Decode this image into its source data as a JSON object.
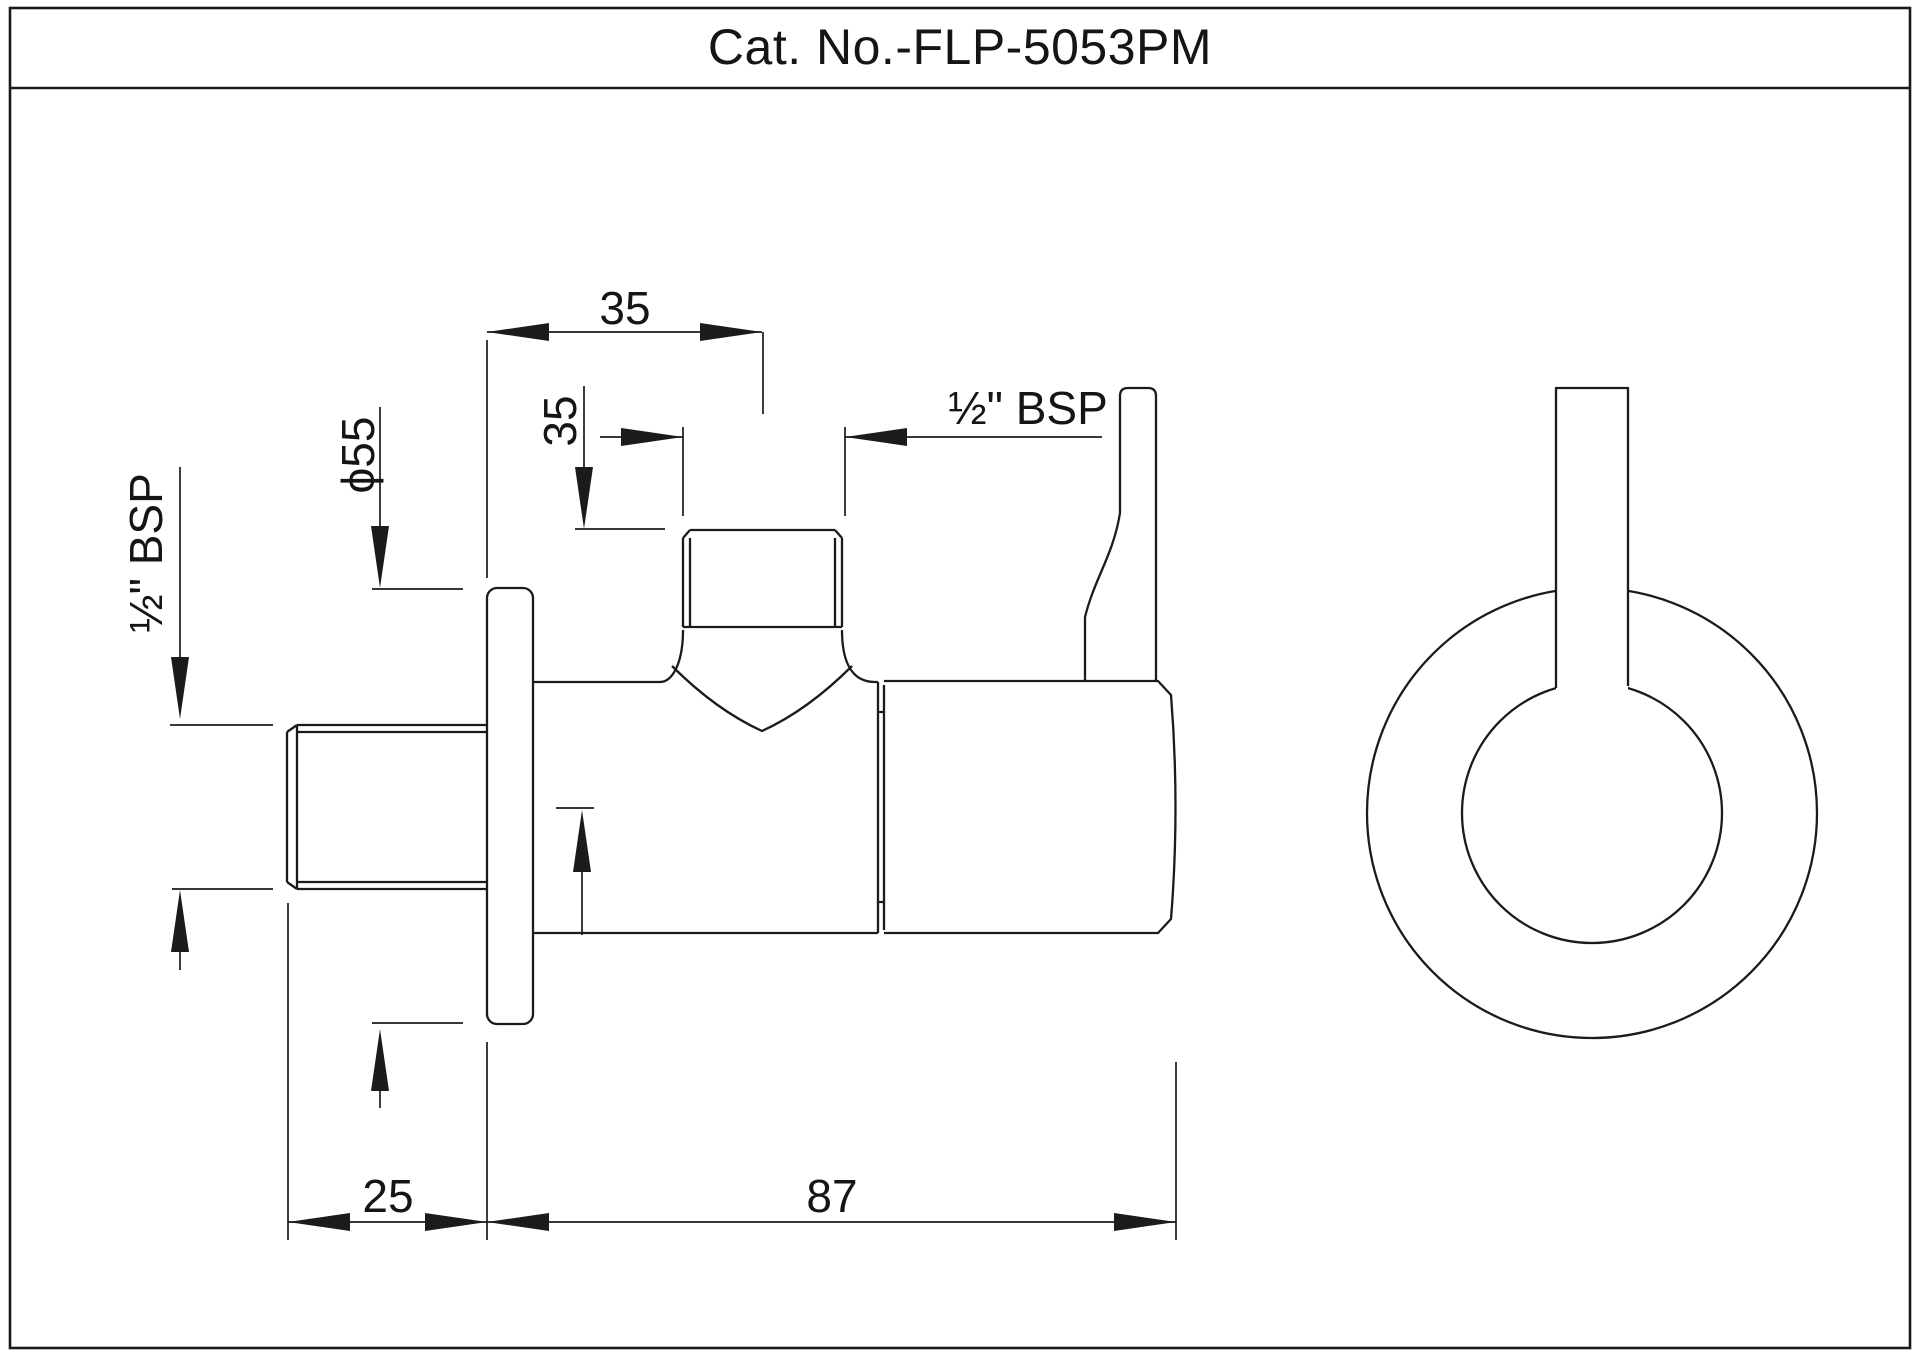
{
  "title": "Cat. No.-FLP-5053PM",
  "colors": {
    "line": "#1b1b1b",
    "background": "#ffffff"
  },
  "dimensions": {
    "top_width": "35",
    "outlet_height": "35",
    "outlet_thread": "½\" BSP",
    "inlet_thread": "½\" BSP",
    "flange_diameter": "ϕ55",
    "inlet_length": "25",
    "body_length": "87"
  }
}
